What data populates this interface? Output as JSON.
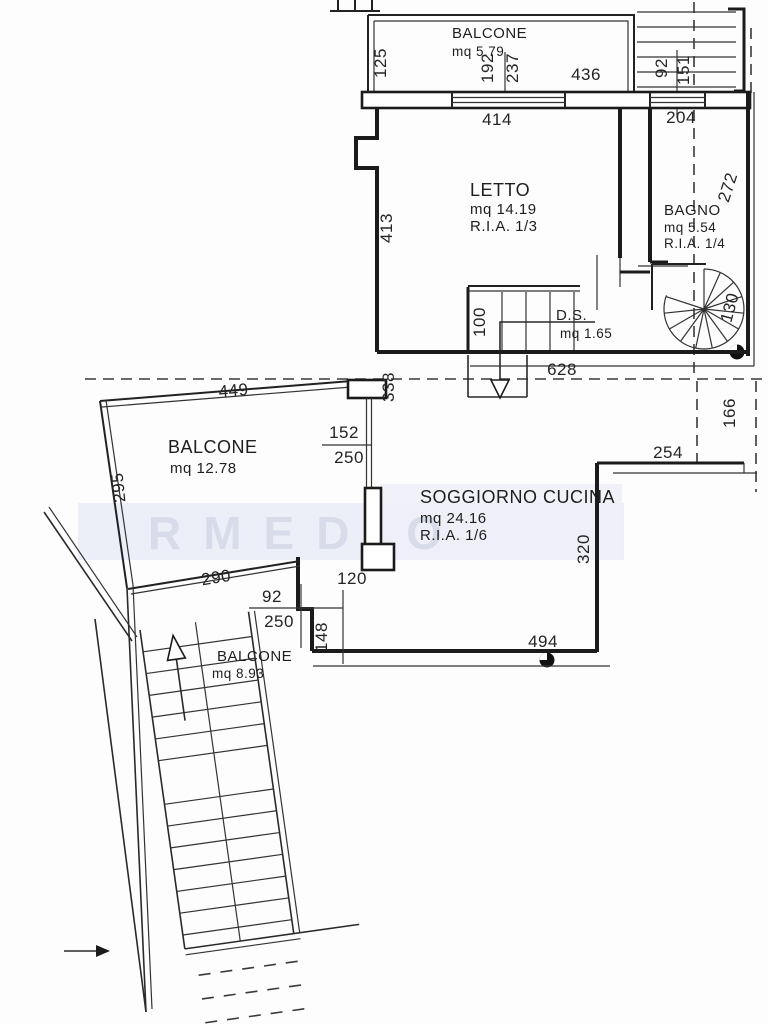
{
  "watermark": "RMEDIO",
  "rooms": {
    "balcone_top": {
      "name": "BALCONE",
      "area": "mq 5.79"
    },
    "letto": {
      "name": "LETTO",
      "area": "mq 14.19",
      "ria": "R.I.A. 1/3"
    },
    "bagno": {
      "name": "BAGNO",
      "area": "mq 5.54",
      "ria": "R.I.A. 1/4"
    },
    "ds": {
      "name": "D.S.",
      "area": "mq 1.65"
    },
    "balcone_left": {
      "name": "BALCONE",
      "area": "mq 12.78"
    },
    "soggiorno": {
      "name": "SOGGIORNO CUCINA",
      "area": "mq 24.16",
      "ria": "R.I.A. 1/6"
    },
    "balcone_lower": {
      "name": "BALCONE",
      "area": "mq 8.93"
    }
  },
  "dims": {
    "balcone_top_depth": "125",
    "window_192": "192",
    "window_237": "237",
    "balcone_top_width": "436",
    "stair_width": "92",
    "stair_length": "151",
    "bagno_window": "204",
    "letto_width": "414",
    "letto_depth": "413",
    "bagno_depth": "272",
    "spiral_width": "130",
    "ds_width": "100",
    "plan_width": "628",
    "window_338": "338",
    "balcone_left_width": "449",
    "balcone_left_depth": "295",
    "window_152": "152",
    "window_152_h": "250",
    "terrace_254": "254",
    "right_166": "166",
    "balcone_lower_width": "290",
    "soggiorno_depth": "320",
    "soggiorno_width": "494",
    "door_92": "92",
    "door_92_h": "250",
    "opening_120": "120",
    "wall_148": "148"
  }
}
